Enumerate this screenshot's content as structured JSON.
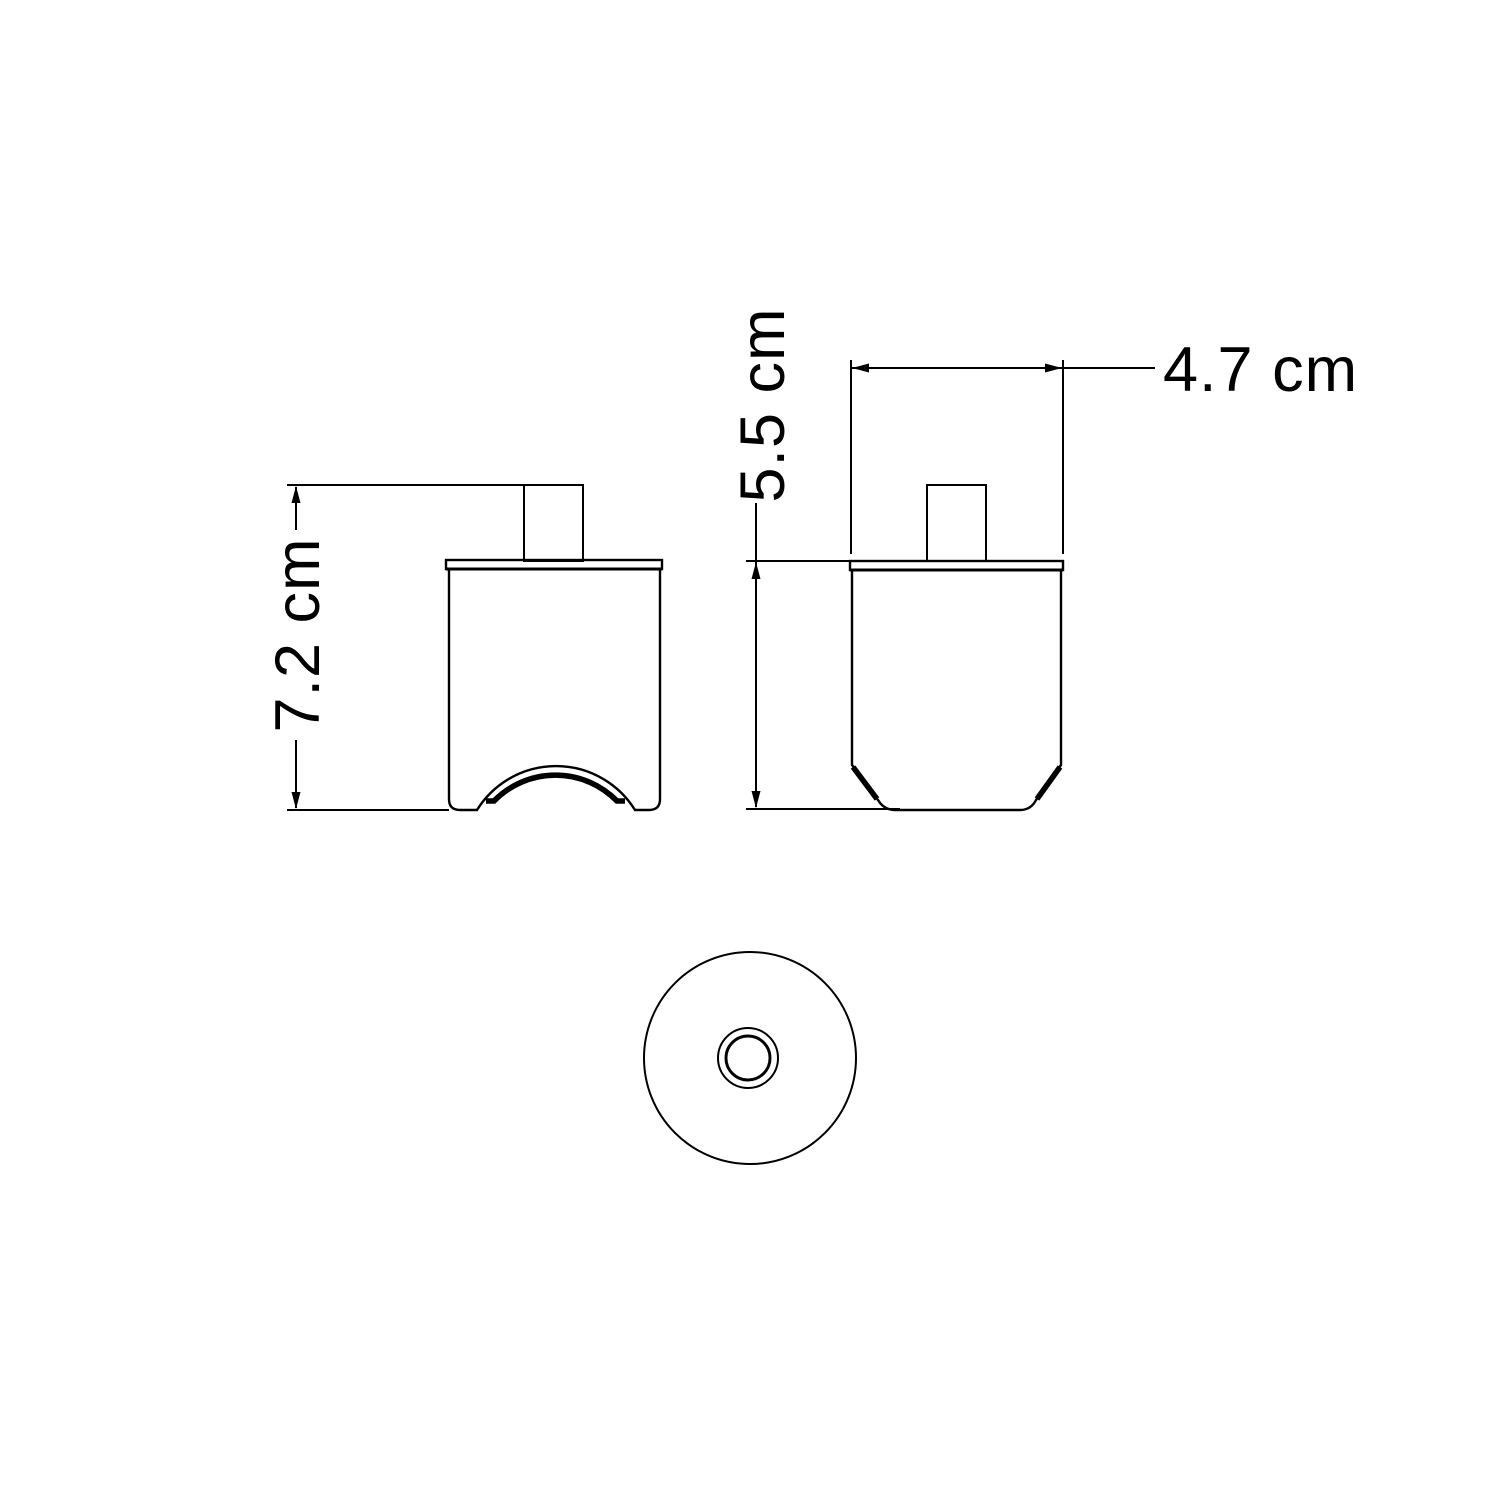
{
  "drawing": {
    "background_color": "#ffffff",
    "line_color": "#000000",
    "views": [
      {
        "id": "front-view",
        "description": "front elevation with top stem and bottom cable arch"
      },
      {
        "id": "side-view",
        "description": "side elevation with top stem and chamfered base"
      },
      {
        "id": "bottom-view",
        "description": "bottom view, outer circle with concentric center hole"
      }
    ],
    "dimensions": [
      {
        "id": "total-height",
        "label": "7.2 cm",
        "value": 7.2,
        "unit": "cm",
        "orientation": "vertical",
        "applies_to": "front-view overall height including stem"
      },
      {
        "id": "body-height",
        "label": "5.5 cm",
        "value": 5.5,
        "unit": "cm",
        "orientation": "vertical",
        "applies_to": "side-view body height excluding stem"
      },
      {
        "id": "body-width",
        "label": "4.7 cm",
        "value": 4.7,
        "unit": "cm",
        "orientation": "horizontal",
        "applies_to": "side-view body width"
      }
    ]
  }
}
